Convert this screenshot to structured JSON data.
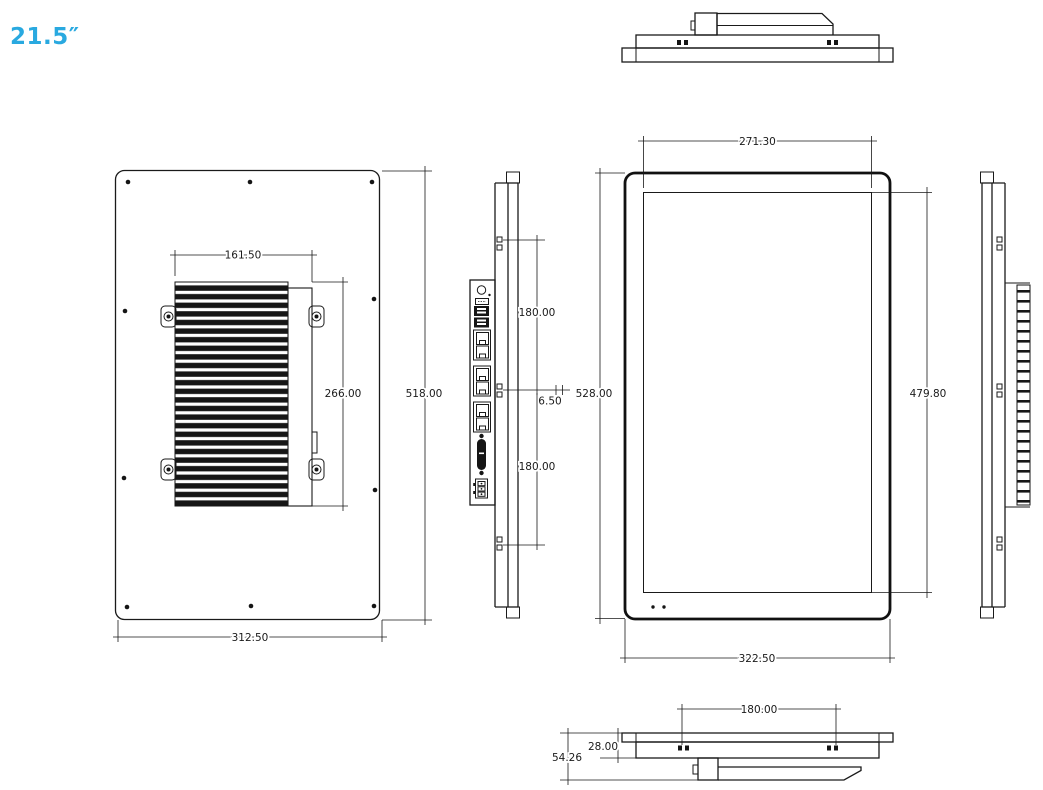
{
  "page": {
    "background": "#ffffff",
    "line_color": "#1a1a1a",
    "accent_color": "#29a9e0"
  },
  "size_label": "21.5″",
  "views": {
    "back": {
      "dims": {
        "heatsink_width": "161.50",
        "heatsink_height": "266.00",
        "body_height": "518.00",
        "body_width": "312.50"
      }
    },
    "left_side": {
      "dims": {
        "vesa_span_upper": "180.00",
        "hole_offset": "6.50",
        "vesa_span_lower": "180.00"
      }
    },
    "front": {
      "dims": {
        "display_width": "271.30",
        "body_height": "528.00",
        "display_height": "479.80",
        "body_width": "322.50"
      }
    },
    "bottom": {
      "dims": {
        "vesa_span": "180.00",
        "panel_depth": "28.00",
        "total_depth": "54.26"
      }
    }
  }
}
